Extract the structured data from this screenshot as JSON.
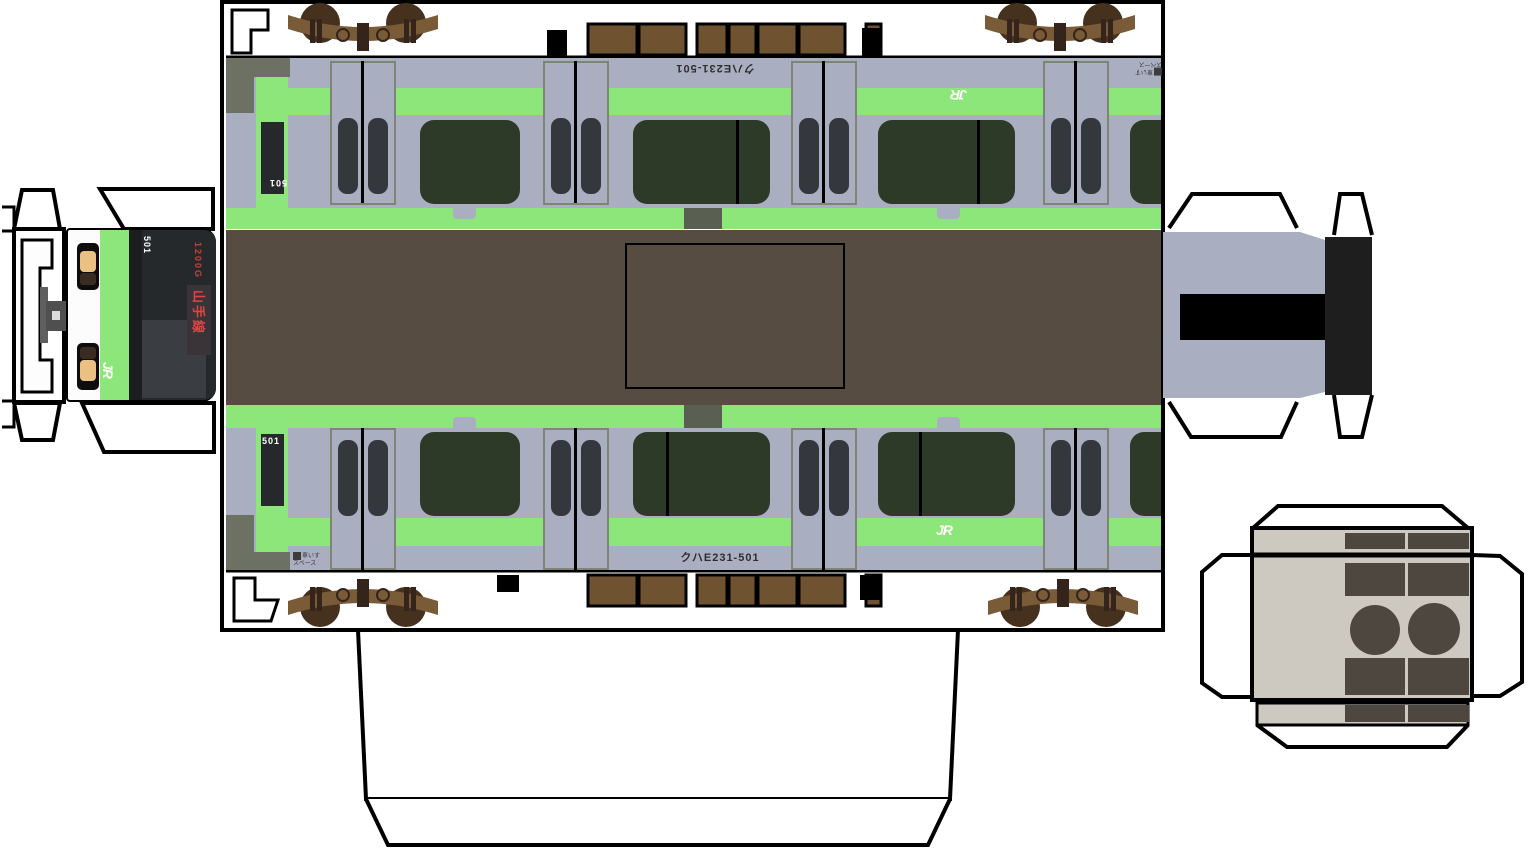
{
  "sheet": {
    "description": "JR East E231-500 Yamanote Line papercraft cut-out template",
    "car_label": "クハE231-501",
    "cab_number": "501",
    "front_number": "501",
    "train_number": "1200G",
    "line_sign": "山手線",
    "jr_logo": "JR",
    "sticker_line1": "車いす",
    "sticker_line2": "スペース"
  },
  "palette": {
    "outline": "#000000",
    "paper": "#ffffff",
    "body_gray": "#a9aec1",
    "stripe_green": "#8de679",
    "window_green": "#2c3a27",
    "door_frame": "#7f8574",
    "door_pane": "#34383d",
    "roof_brown": "#564c42",
    "vent_brown": "#6f522f",
    "bogie_frame": "#7a5b38",
    "bogie_wheel": "#46311f",
    "bogie_dark": "#35241b",
    "cab_block": "#6c7163",
    "tab_dark": "#596052",
    "equip_beige": "#cdc8c0",
    "equip_dark": "#4e473f",
    "amber": "#ebc183",
    "signal_red": "#c5413a",
    "sign_red": "#e04545",
    "windshield": "#26292b",
    "windshield_light": "#3a3e42",
    "sign_panel": "#3a3337",
    "headlight_brown": "#3a2c22",
    "coupler_gray": "#4f4f4f",
    "coupler_slab": "#5f5f5f",
    "end_black": "#1e1e1e"
  }
}
